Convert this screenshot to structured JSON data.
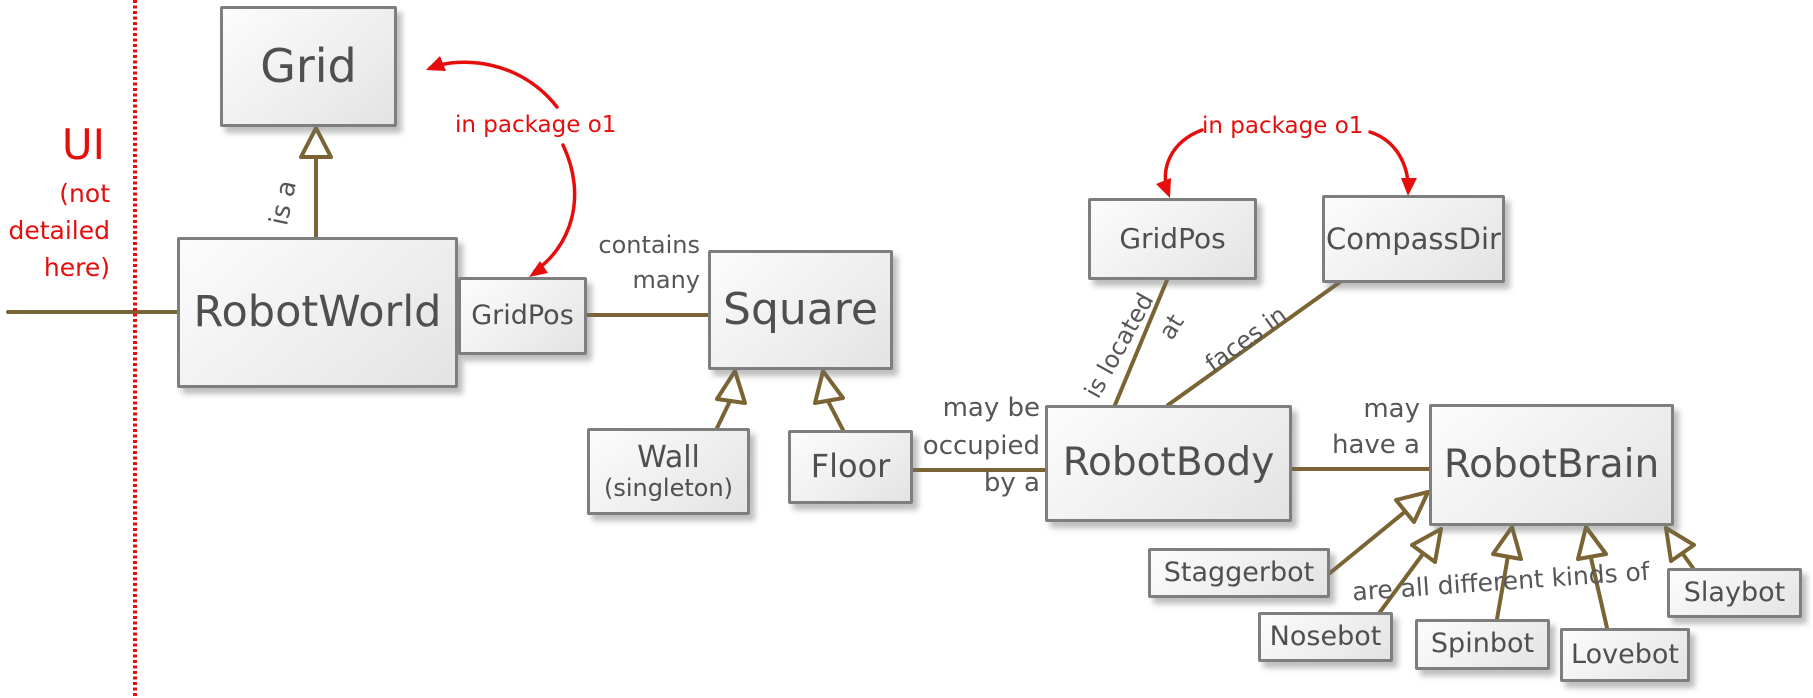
{
  "canvas": {
    "width": 1813,
    "height": 698
  },
  "colors": {
    "red": "#e60d0d",
    "line-brown": "#7a6433",
    "box-border": "#7e7e7e",
    "text-gray": "#4f4f4f",
    "label-gray": "#565656"
  },
  "ui_region": {
    "title": "UI",
    "note": "(not\ndetailed\nhere)"
  },
  "annotations": {
    "package_note_left": "in package o1",
    "package_note_right": "in package o1"
  },
  "classes": {
    "grid": {
      "label": "Grid"
    },
    "robotworld": {
      "label": "RobotWorld"
    },
    "gridpos_world": {
      "label": "GridPos"
    },
    "square": {
      "label": "Square"
    },
    "wall": {
      "label": "Wall",
      "sublabel": "(singleton)"
    },
    "floor": {
      "label": "Floor"
    },
    "robotbody": {
      "label": "RobotBody"
    },
    "gridpos_body": {
      "label": "GridPos"
    },
    "compassdir": {
      "label": "CompassDir"
    },
    "robotbrain": {
      "label": "RobotBrain"
    },
    "staggerbot": {
      "label": "Staggerbot"
    },
    "nosebot": {
      "label": "Nosebot"
    },
    "spinbot": {
      "label": "Spinbot"
    },
    "lovebot": {
      "label": "Lovebot"
    },
    "slaybot": {
      "label": "Slaybot"
    }
  },
  "relations": {
    "is_a": "is a",
    "contains_many": "contains\nmany",
    "may_be_occupied": "may be\noccupied\nby a",
    "is_located": "is located",
    "at": "at",
    "faces_in": "faces in",
    "may_have_a": "may\nhave a",
    "kinds_of": "are all different kinds of"
  }
}
